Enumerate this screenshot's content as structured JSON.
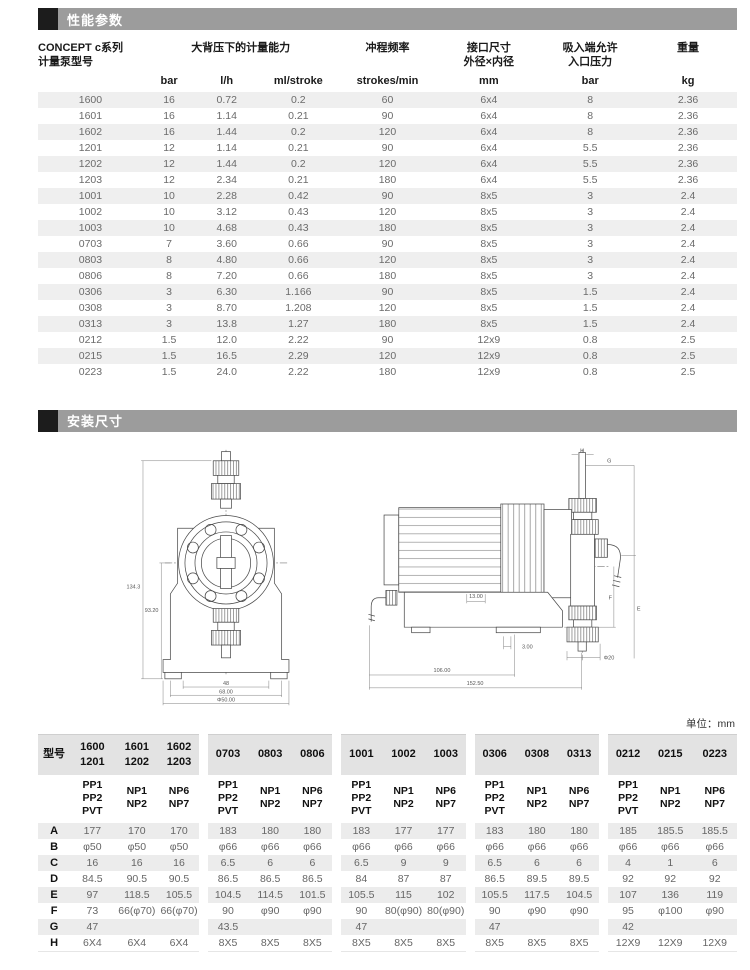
{
  "sections": {
    "performance": {
      "title": "性能参数"
    },
    "installation": {
      "title": "安装尺寸"
    }
  },
  "perf": {
    "col_headers": {
      "model": "CONCEPT c系列\n计量泵型号",
      "capacity": "大背压下的计量能力",
      "stroke_freq": "冲程频率",
      "connection": "接口尺寸\n外径×内径",
      "suction": "吸入端允许\n入口压力",
      "weight": "重量"
    },
    "units": [
      "bar",
      "l/h",
      "ml/stroke",
      "strokes/min",
      "mm",
      "bar",
      "kg"
    ],
    "rows": [
      [
        "1600",
        "16",
        "0.72",
        "0.2",
        "60",
        "6x4",
        "8",
        "2.36"
      ],
      [
        "1601",
        "16",
        "1.14",
        "0.21",
        "90",
        "6x4",
        "8",
        "2.36"
      ],
      [
        "1602",
        "16",
        "1.44",
        "0.2",
        "120",
        "6x4",
        "8",
        "2.36"
      ],
      [
        "1201",
        "12",
        "1.14",
        "0.21",
        "90",
        "6x4",
        "5.5",
        "2.36"
      ],
      [
        "1202",
        "12",
        "1.44",
        "0.2",
        "120",
        "6x4",
        "5.5",
        "2.36"
      ],
      [
        "1203",
        "12",
        "2.34",
        "0.21",
        "180",
        "6x4",
        "5.5",
        "2.36"
      ],
      [
        "1001",
        "10",
        "2.28",
        "0.42",
        "90",
        "8x5",
        "3",
        "2.4"
      ],
      [
        "1002",
        "10",
        "3.12",
        "0.43",
        "120",
        "8x5",
        "3",
        "2.4"
      ],
      [
        "1003",
        "10",
        "4.68",
        "0.43",
        "180",
        "8x5",
        "3",
        "2.4"
      ],
      [
        "0703",
        "7",
        "3.60",
        "0.66",
        "90",
        "8x5",
        "3",
        "2.4"
      ],
      [
        "0803",
        "8",
        "4.80",
        "0.66",
        "120",
        "8x5",
        "3",
        "2.4"
      ],
      [
        "0806",
        "8",
        "7.20",
        "0.66",
        "180",
        "8x5",
        "3",
        "2.4"
      ],
      [
        "0306",
        "3",
        "6.30",
        "1.166",
        "90",
        "8x5",
        "1.5",
        "2.4"
      ],
      [
        "0308",
        "3",
        "8.70",
        "1.208",
        "120",
        "8x5",
        "1.5",
        "2.4"
      ],
      [
        "0313",
        "3",
        "13.8",
        "1.27",
        "180",
        "8x5",
        "1.5",
        "2.4"
      ],
      [
        "0212",
        "1.5",
        "12.0",
        "2.22",
        "90",
        "12x9",
        "0.8",
        "2.5"
      ],
      [
        "0215",
        "1.5",
        "16.5",
        "2.29",
        "120",
        "12x9",
        "0.8",
        "2.5"
      ],
      [
        "0223",
        "1.5",
        "24.0",
        "2.22",
        "180",
        "12x9",
        "0.8",
        "2.5"
      ]
    ]
  },
  "drawings": {
    "front_view": {
      "dim_total_height": "134.3",
      "dim_center_height": "93.20",
      "dim_feet": "48",
      "dim_base": "68.00",
      "dim_dia": "Φ50.00"
    },
    "side_view": {
      "dim_h": "H",
      "dim_g": "G",
      "dim_foot": "13.00",
      "dim_foot2": "3.00",
      "dim_dia": "Φ20",
      "dim_len1": "106.00",
      "dim_len2": "152.50",
      "dim_f": "F",
      "dim_e": "E"
    }
  },
  "unit_note": "单位：mm",
  "dims": {
    "model_label": "型号",
    "model_cols": [
      "1600\n1201",
      "1601\n1202",
      "1602\n1203",
      "0703",
      "0803",
      "0806",
      "1001",
      "1002",
      "1003",
      "0306",
      "0308",
      "0313",
      "0212",
      "0215",
      "0223"
    ],
    "material_cols": [
      "PP1\nPP2\nPVT",
      "NP1\nNP2",
      "NP6\nNP7",
      "PP1\nPP2\nPVT",
      "NP1\nNP2",
      "NP6\nNP7",
      "PP1\nPP2\nPVT",
      "NP1\nNP2",
      "NP6\nNP7",
      "PP1\nPP2\nPVT",
      "NP1\nNP2",
      "NP6\nNP7",
      "PP1\nPP2\nPVT",
      "NP1\nNP2",
      "NP6\nNP7"
    ],
    "rows": [
      [
        "A",
        "177",
        "170",
        "170",
        "183",
        "180",
        "180",
        "183",
        "177",
        "177",
        "183",
        "180",
        "180",
        "185",
        "185.5",
        "185.5"
      ],
      [
        "B",
        "φ50",
        "φ50",
        "φ50",
        "φ66",
        "φ66",
        "φ66",
        "φ66",
        "φ66",
        "φ66",
        "φ66",
        "φ66",
        "φ66",
        "φ66",
        "φ66",
        "φ66"
      ],
      [
        "C",
        "16",
        "16",
        "16",
        "6.5",
        "6",
        "6",
        "6.5",
        "9",
        "9",
        "6.5",
        "6",
        "6",
        "4",
        "1",
        "6"
      ],
      [
        "D",
        "84.5",
        "90.5",
        "90.5",
        "86.5",
        "86.5",
        "86.5",
        "84",
        "87",
        "87",
        "86.5",
        "89.5",
        "89.5",
        "92",
        "92",
        "92"
      ],
      [
        "E",
        "97",
        "118.5",
        "105.5",
        "104.5",
        "114.5",
        "101.5",
        "105.5",
        "115",
        "102",
        "105.5",
        "117.5",
        "104.5",
        "107",
        "136",
        "119"
      ],
      [
        "F",
        "73",
        "66(φ70)",
        "66(φ70)",
        "90",
        "φ90",
        "φ90",
        "90",
        "80(φ90)",
        "80(φ90)",
        "90",
        "φ90",
        "φ90",
        "95",
        "φ100",
        "φ90"
      ],
      [
        "G",
        "47",
        "",
        "",
        "43.5",
        "",
        "",
        "47",
        "",
        "",
        "47",
        "",
        "",
        "42",
        "",
        ""
      ],
      [
        "H",
        "6X4",
        "6X4",
        "6X4",
        "8X5",
        "8X5",
        "8X5",
        "8X5",
        "8X5",
        "8X5",
        "8X5",
        "8X5",
        "8X5",
        "12X9",
        "12X9",
        "12X9"
      ]
    ]
  }
}
